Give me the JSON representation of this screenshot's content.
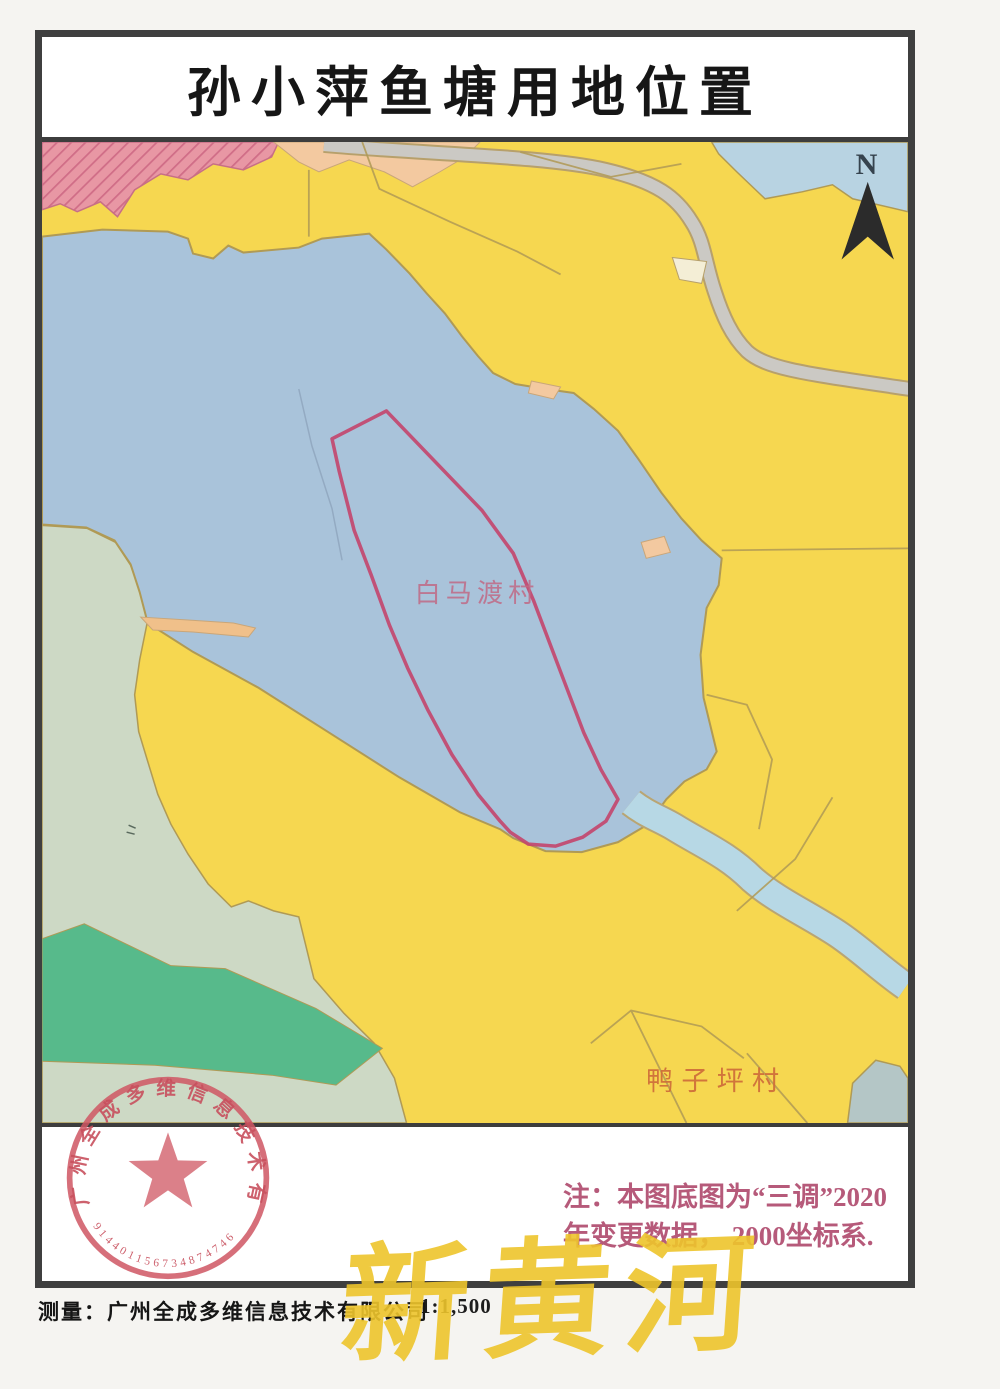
{
  "page": {
    "title": "孙小萍鱼塘用地位置",
    "north_label": "N",
    "scale": "1:1,500",
    "caption": "测量：广州全成多维信息技术有限公司",
    "watermark": "新黄河"
  },
  "map": {
    "labels": [
      {
        "text": "白马渡村"
      },
      {
        "text": "鸭子坪村"
      }
    ],
    "note_line1": "注：本图底图为“三调”2020",
    "note_line2": "年变更数据， 2000坐标系."
  },
  "stamp": {
    "company": "广州全成多维信息技术有限公司",
    "code": "914401156734874746"
  },
  "colors": {
    "farmland_yellow": "#f6d750",
    "lake_blue": "#a9c3da",
    "river_blue": "#b7d8e5",
    "pale_green": "#cdd9c5",
    "dark_green": "#57ba8b",
    "pink_hatch": "#e897a4",
    "peach": "#f3c9a0",
    "road_gray": "#cbc9c4",
    "boundary_olive": "#b09a55",
    "parcel_outline_red": "#c3456b",
    "note_pink": "#b65a7a",
    "watermark_yellow": "#edc42b",
    "stamp_red": "#cf5663"
  }
}
